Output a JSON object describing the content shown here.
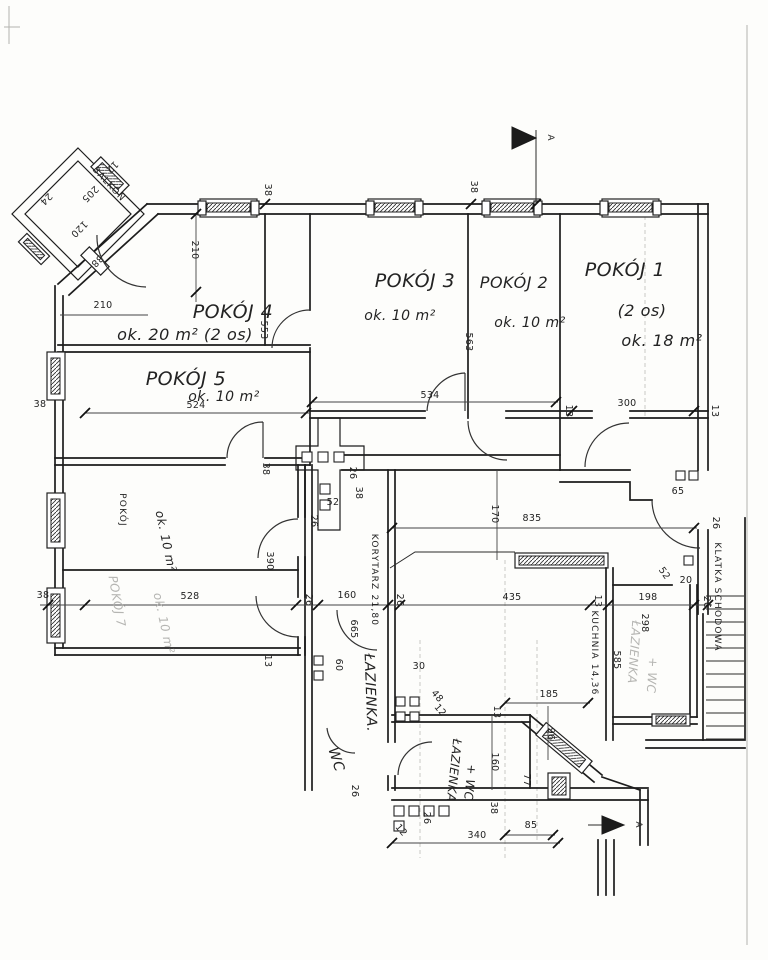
{
  "drawing": {
    "section_marker": "A",
    "rooms": {
      "balkon": {
        "name": "BALKON"
      },
      "pokoj4": {
        "name": "POKÓJ 4",
        "area": "ok. 20 m² (2 os)"
      },
      "pokoj3": {
        "name": "POKÓJ 3",
        "area": "ok. 10 m²"
      },
      "pokoj2": {
        "name": "POKÓJ 2",
        "area": "ok. 10 m²"
      },
      "pokoj1": {
        "name": "POKÓJ 1",
        "persons": "(2 os)",
        "area": "ok. 18 m²"
      },
      "pokoj5": {
        "name": "POKÓJ 5",
        "area": "ok. 10 m²"
      },
      "pokoj6": {
        "name": "POKÓJ",
        "area": "ok. 10 m²"
      },
      "pokoj7": {
        "name": "POKÓJ 7",
        "area": "ok. 10 m²"
      },
      "korytarz": {
        "name": "KORYTARZ 21,80"
      },
      "lazienka": {
        "name": "ŁAZIENKA."
      },
      "wc": {
        "name": "WC"
      },
      "lazienka_wc": {
        "name": "ŁAZIENKA",
        "suffix": "+ WC"
      },
      "kuchnia": {
        "name": "KUCHNIA 14,36"
      },
      "lazienka_wc2": {
        "name": "ŁAZIENKA",
        "suffix": "+ WC"
      },
      "klatka": {
        "name": "KLATKA SCHODOWA"
      }
    },
    "dimensions": [
      {
        "t": "38",
        "x": 265,
        "y": 190,
        "r": 90
      },
      {
        "t": "38",
        "x": 471,
        "y": 187,
        "r": 90
      },
      {
        "t": "210",
        "x": 192,
        "y": 250,
        "r": 90
      },
      {
        "t": "210",
        "x": 103,
        "y": 308,
        "r": 0
      },
      {
        "t": "553",
        "x": 261,
        "y": 330,
        "r": 90
      },
      {
        "t": "563",
        "x": 466,
        "y": 342,
        "r": 90
      },
      {
        "t": "534",
        "x": 430,
        "y": 398,
        "r": 0
      },
      {
        "t": "524",
        "x": 196,
        "y": 408,
        "r": 0
      },
      {
        "t": "38",
        "x": 40,
        "y": 407,
        "r": 0
      },
      {
        "t": "300",
        "x": 627,
        "y": 406,
        "r": 0
      },
      {
        "t": "13",
        "x": 566,
        "y": 411,
        "r": 90
      },
      {
        "t": "13",
        "x": 712,
        "y": 411,
        "r": 90
      },
      {
        "t": "205",
        "x": 88,
        "y": 192,
        "r": 135
      },
      {
        "t": "120",
        "x": 77,
        "y": 227,
        "r": 135
      },
      {
        "t": "12",
        "x": 110,
        "y": 165,
        "r": 135
      },
      {
        "t": "24",
        "x": 44,
        "y": 197,
        "r": 135
      },
      {
        "t": "38",
        "x": 95,
        "y": 259,
        "r": 135
      },
      {
        "t": "38",
        "x": 263,
        "y": 469,
        "r": 90
      },
      {
        "t": "26",
        "x": 350,
        "y": 473,
        "r": 90
      },
      {
        "t": "38",
        "x": 356,
        "y": 493,
        "r": 90
      },
      {
        "t": "52",
        "x": 333,
        "y": 505,
        "r": 0
      },
      {
        "t": "26",
        "x": 311,
        "y": 521,
        "r": 90
      },
      {
        "t": "390",
        "x": 267,
        "y": 561,
        "r": 90
      },
      {
        "t": "170",
        "x": 492,
        "y": 514,
        "r": 90
      },
      {
        "t": "835",
        "x": 532,
        "y": 521,
        "r": 0
      },
      {
        "t": "65",
        "x": 678,
        "y": 494,
        "r": 0
      },
      {
        "t": "26",
        "x": 713,
        "y": 523,
        "r": 90
      },
      {
        "t": "52",
        "x": 662,
        "y": 575,
        "r": 55
      },
      {
        "t": "20",
        "x": 686,
        "y": 583,
        "r": 0
      },
      {
        "t": "528",
        "x": 190,
        "y": 599,
        "r": 0
      },
      {
        "t": "38",
        "x": 43,
        "y": 598,
        "r": 0
      },
      {
        "t": "26",
        "x": 306,
        "y": 600,
        "r": 90
      },
      {
        "t": "160",
        "x": 347,
        "y": 598,
        "r": 0
      },
      {
        "t": "26",
        "x": 397,
        "y": 600,
        "r": 90
      },
      {
        "t": "435",
        "x": 512,
        "y": 600,
        "r": 0
      },
      {
        "t": "13",
        "x": 595,
        "y": 601,
        "r": 90
      },
      {
        "t": "198",
        "x": 648,
        "y": 600,
        "r": 0
      },
      {
        "t": "26",
        "x": 704,
        "y": 602,
        "r": 90
      },
      {
        "t": "13",
        "x": 265,
        "y": 661,
        "r": 90
      },
      {
        "t": "665",
        "x": 351,
        "y": 629,
        "r": 90
      },
      {
        "t": "60",
        "x": 336,
        "y": 665,
        "r": 90
      },
      {
        "t": "30",
        "x": 419,
        "y": 669,
        "r": 0
      },
      {
        "t": "48",
        "x": 435,
        "y": 698,
        "r": 50
      },
      {
        "t": "12",
        "x": 438,
        "y": 712,
        "r": 50
      },
      {
        "t": "185",
        "x": 549,
        "y": 697,
        "r": 0
      },
      {
        "t": "96",
        "x": 548,
        "y": 734,
        "r": 90
      },
      {
        "t": "13",
        "x": 494,
        "y": 712,
        "r": 90
      },
      {
        "t": "160",
        "x": 492,
        "y": 762,
        "r": 90
      },
      {
        "t": "77",
        "x": 524,
        "y": 780,
        "r": 90
      },
      {
        "t": "298",
        "x": 642,
        "y": 623,
        "r": 90
      },
      {
        "t": "585",
        "x": 614,
        "y": 660,
        "r": 90
      },
      {
        "t": "38",
        "x": 491,
        "y": 808,
        "r": 90
      },
      {
        "t": "26",
        "x": 424,
        "y": 818,
        "r": 90
      },
      {
        "t": "12",
        "x": 399,
        "y": 832,
        "r": 50
      },
      {
        "t": "26",
        "x": 352,
        "y": 791,
        "r": 90
      },
      {
        "t": "85",
        "x": 531,
        "y": 828,
        "r": 0
      },
      {
        "t": "340",
        "x": 477,
        "y": 838,
        "r": 0
      }
    ]
  }
}
